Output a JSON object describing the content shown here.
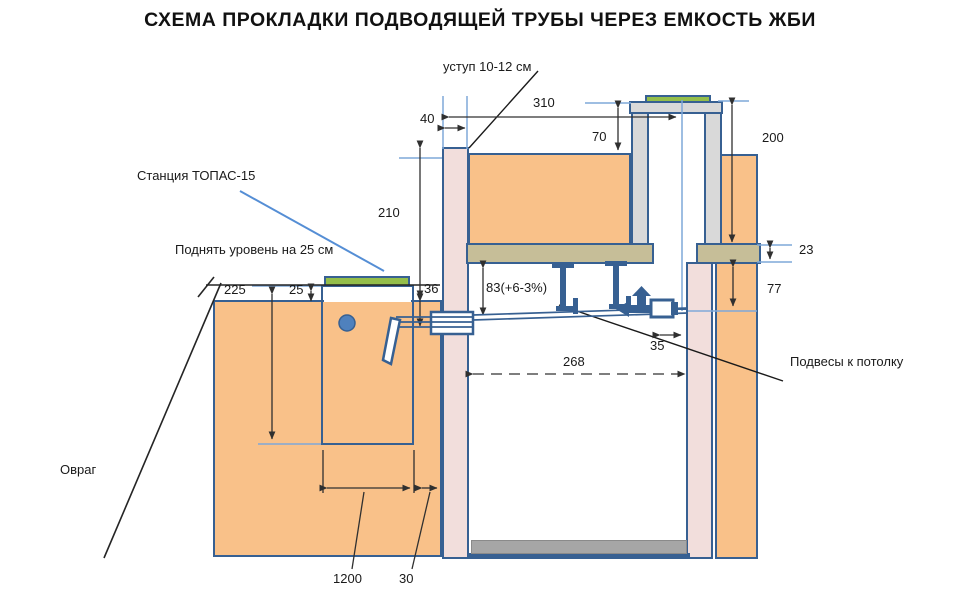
{
  "title": "СХЕМА ПРОКЛАДКИ ПОДВОДЯЩЕЙ ТРУБЫ ЧЕРЕЗ ЕМКОСТЬ ЖБИ",
  "labels": {
    "ledge": "уступ 10-12 см",
    "station": "Станция ТОПАС-15",
    "raise_level": "Поднять уровень на 25 см",
    "ceiling_hangers": "Подвесы к потолку",
    "ravine": "Овраг"
  },
  "dimensions": {
    "d310": "310",
    "d40": "40",
    "d70": "70",
    "d200": "200",
    "d210": "210",
    "d36": "36",
    "d83": "83(+6-3%)",
    "d23": "23",
    "d77": "77",
    "d225": "225",
    "d25": "25",
    "d268": "268",
    "d35": "35",
    "d1200": "1200",
    "d30": "30"
  },
  "colors": {
    "soil_fill": "#F9C189",
    "wall_fill": "#F2DEDC",
    "slab_fill": "#C6BE98",
    "lid_green": "#94BE4A",
    "concrete_gray": "#D9D9D9",
    "floor_gray": "#A6A6A6",
    "outline_blue": "#376092",
    "guide_blue": "#7FA8D9",
    "accent_blue": "#4F81BD",
    "dimension_line": "#303030"
  }
}
